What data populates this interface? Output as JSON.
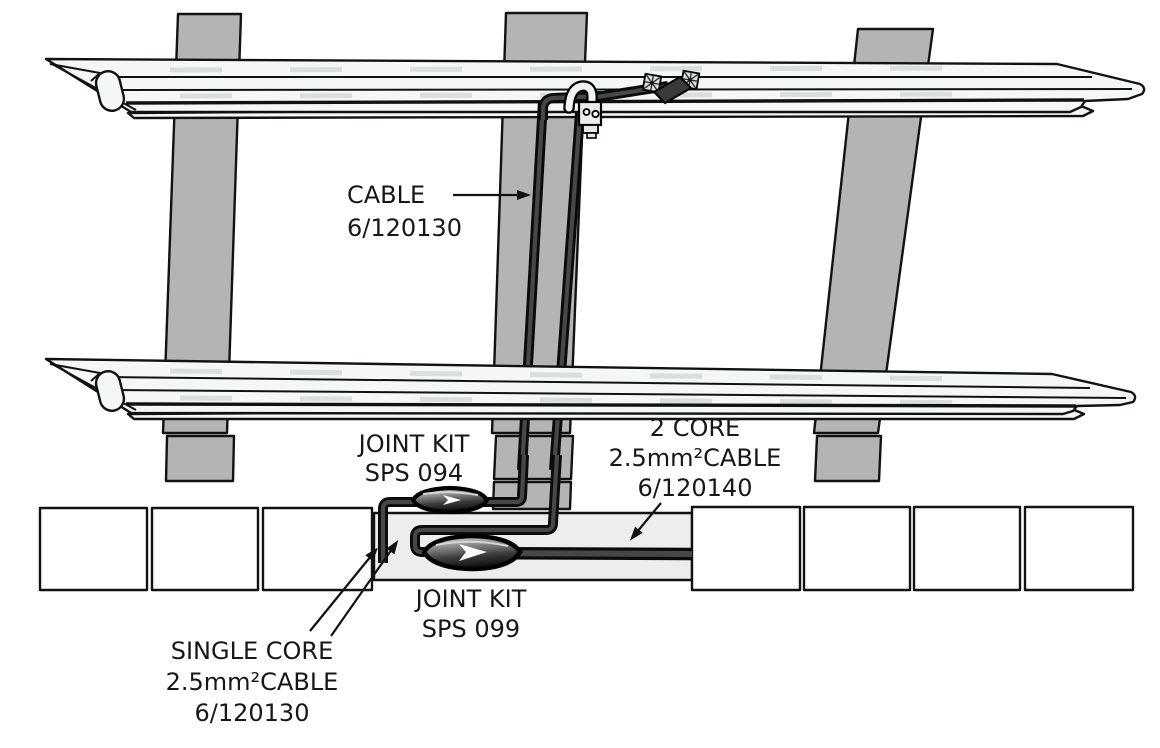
{
  "labels": {
    "cable": {
      "lines": [
        "CABLE",
        "6/120130"
      ]
    },
    "joint_kit_top": {
      "lines": [
        "JOINT KIT",
        "SPS 094"
      ]
    },
    "two_core_cable": {
      "lines": [
        "2 CORE",
        "2.5mm²CABLE",
        "6/120140"
      ]
    },
    "joint_kit_bottom": {
      "lines": [
        "JOINT KIT",
        "SPS 099"
      ]
    },
    "single_core_cable": {
      "lines": [
        "SINGLE CORE",
        "2.5mm²CABLE",
        "6/120130"
      ]
    }
  },
  "colors": {
    "outline": "#121212",
    "sleeper_fill": "#b4b4b4",
    "rail_fill": "#f4f7f7",
    "trough_fill": "#ededed",
    "box_fill": "#ffffff",
    "cable_dark": "#0b0b0b",
    "label_text": "#171717",
    "background": "#ffffff"
  }
}
